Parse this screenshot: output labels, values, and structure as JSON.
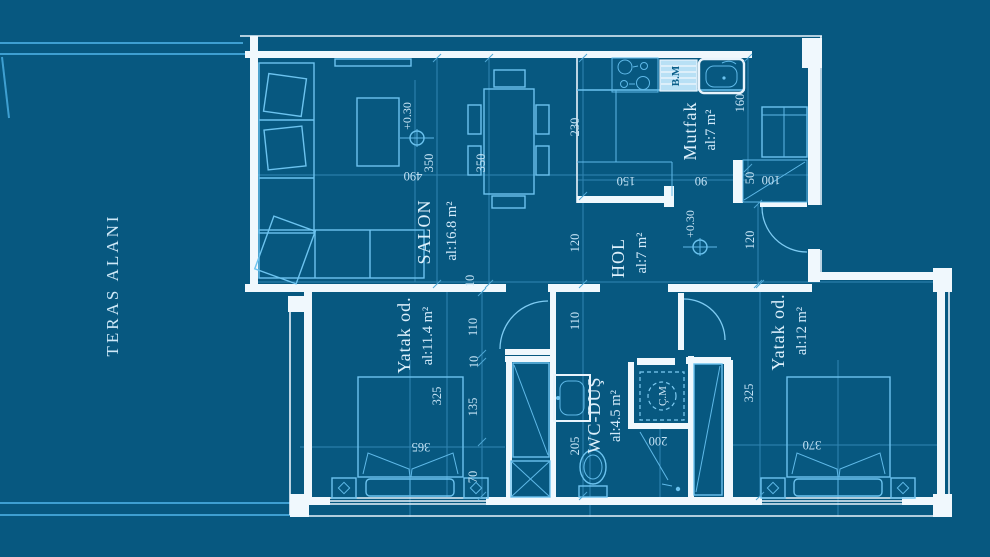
{
  "colors": {
    "background": "#075880",
    "walls": "#f0f8fd",
    "furniture_lines": "#6cc3ef",
    "dimension_lines": "#4ea6d4",
    "label_text": "#dceffb",
    "dishwasher_fill": "#b8e0f5"
  },
  "terrace": {
    "label": "TERAS ALANI"
  },
  "rooms": {
    "salon": {
      "name": "SALON",
      "area": "al:16.8 m²"
    },
    "hol": {
      "name": "HOL",
      "area": "al:7 m²"
    },
    "mutfak": {
      "name": "Mutfak",
      "area": "al:7 m²"
    },
    "yatak1": {
      "name": "Yatak od.",
      "area": "al:11.4 m²"
    },
    "wc": {
      "name": "WC-DUŞ",
      "area": "al:4.5 m²"
    },
    "yatak2": {
      "name": "Yatak od.",
      "area": "al:12 m²"
    }
  },
  "appliances": {
    "dishwasher": "B.M",
    "washing_machine": "Ç.M"
  },
  "levels": {
    "salon": "+0.30",
    "hol": "+0.30"
  },
  "dims": {
    "t350a": "350",
    "t350b": "350",
    "t490": "490",
    "t230": "230",
    "t150": "150",
    "t90": "90",
    "t160": "160",
    "t50": "50",
    "t100": "100",
    "t120a": "120",
    "t120b": "120",
    "t110a": "110",
    "t110b": "110",
    "t10a": "10",
    "t10b": "10",
    "t135": "135",
    "t70": "70",
    "t325a": "325",
    "t365": "365",
    "t205": "205",
    "t200": "200",
    "t325b": "325",
    "t370": "370"
  }
}
